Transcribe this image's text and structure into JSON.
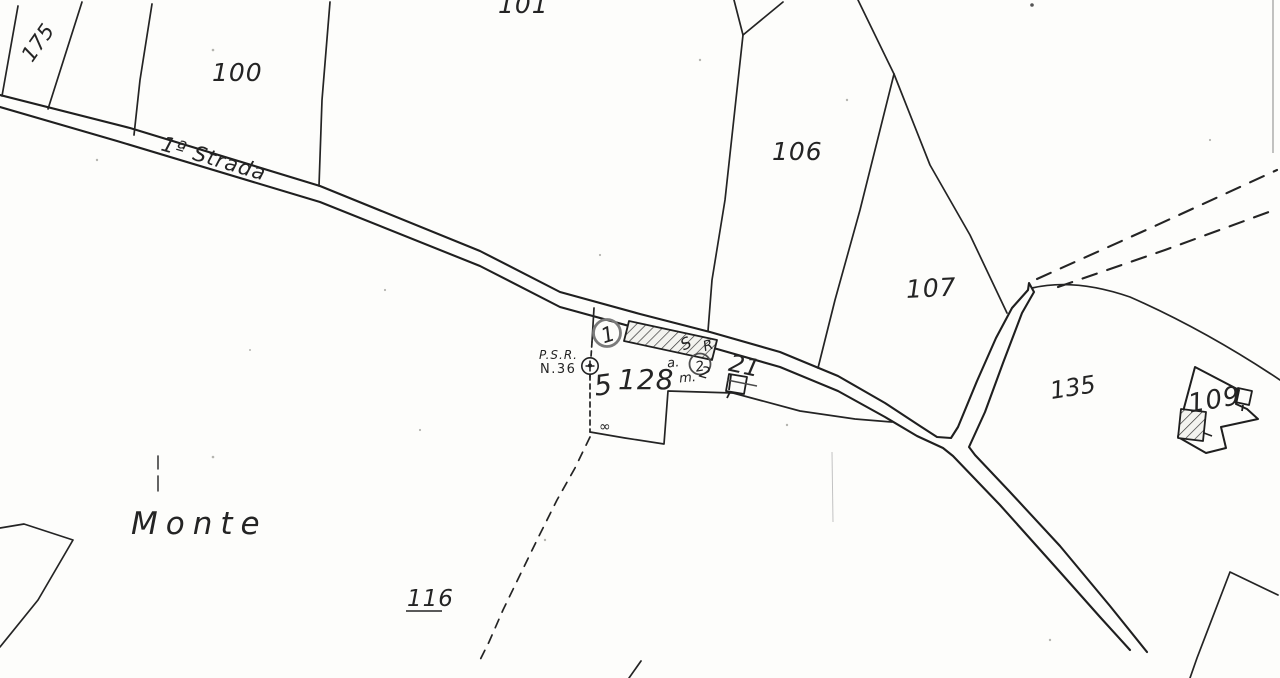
{
  "map": {
    "type": "cadastral-scan",
    "colors": {
      "ink": "#1f1f1f",
      "pencil": "#555555",
      "faint_pencil": "#b9b9b9",
      "paper": "#fdfdfb"
    },
    "labels": {
      "parcels": {
        "p100": "100",
        "p101": "101",
        "p106": "106",
        "p107": "107",
        "p109": "109",
        "p116": "116",
        "p128": "128"
      },
      "road": "1ª Strada",
      "place": "Monte",
      "handwritten": {
        "h175": "175",
        "h135": "135",
        "psr_line1": "P.S.R.",
        "psr_line2": "N.36",
        "h5": "5",
        "circled_no1": "1",
        "circled_no2": "2",
        "scribble_a": "a.",
        "scribble_s": "S",
        "scribble_r": "R",
        "scribble_m": "m.",
        "scribble_2": "2",
        "h21": "21",
        "squiggle": "∞"
      }
    }
  }
}
